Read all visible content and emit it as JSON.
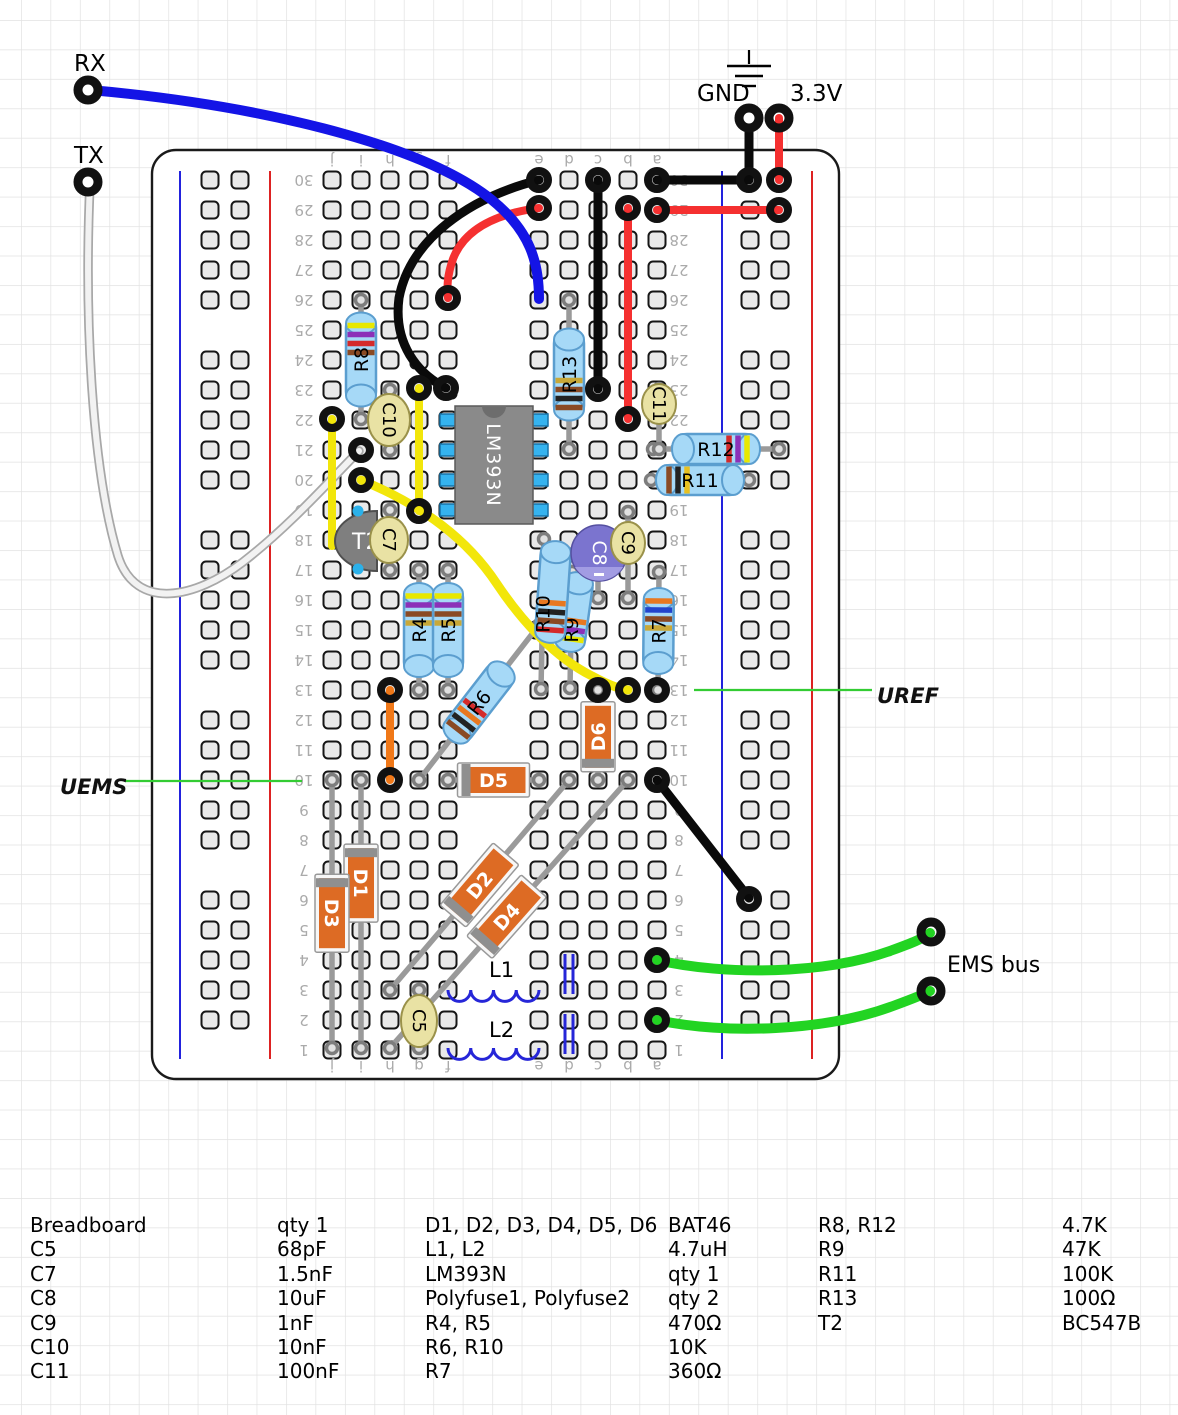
{
  "labels": {
    "rx": "RX",
    "tx": "TX",
    "gnd": "GND",
    "v33": "3.3V",
    "uref": "UREF",
    "uems": "UEMS",
    "ems_bus": "EMS bus"
  },
  "palette": {
    "grid": "#e2e2e2",
    "hole_fill": "#e9e9e9",
    "hole_stroke": "#161616",
    "rail_blue": "#2222dd",
    "rail_red": "#dd2222",
    "resistor_fill": "#a6d9f7",
    "resistor_stroke": "#5b9ecf",
    "diode_fill": "#dd6b24",
    "diode_band": "#8f8f8f",
    "cap_fill": "#e9e2a4",
    "cap_stroke": "#9a914a",
    "elco_fill": "#7b74cf",
    "elco_light": "#a29ce3",
    "ic_fill": "#8a8a8a",
    "ic_pin": "#35b3ef",
    "wire_black": "#0a0a0a",
    "wire_red": "#f53030",
    "wire_blue": "#1414e6",
    "wire_yellow": "#f2e60a",
    "wire_orange": "#f07818",
    "wire_green": "#22d422",
    "wire_white": "#f2f2f2",
    "callout_green": "#33cc33",
    "lead": "#9a9a9a",
    "label_gray": "#aaaaaa"
  },
  "board": {
    "x": 152,
    "y": 150,
    "w": 687,
    "h": 929,
    "rows": 30,
    "row_y30": 180,
    "pitch": 30,
    "cols": {
      "j": 332,
      "i": 361,
      "h": 390,
      "g": 419,
      "f": 448,
      "e": 539,
      "d": 569,
      "c": 598,
      "b": 628,
      "a": 657
    },
    "col_letters": [
      "j",
      "i",
      "h",
      "g",
      "f",
      "e",
      "d",
      "c",
      "b",
      "a"
    ],
    "letters_y": [
      160,
      1066
    ],
    "numbers_x": [
      304,
      679
    ],
    "left_rail": {
      "blue": 180,
      "red": 270,
      "cols": [
        210,
        240
      ]
    },
    "right_rail": {
      "blue": 722,
      "red": 812,
      "cols": [
        750,
        780
      ]
    },
    "rail_y": [
      171,
      1059
    ]
  },
  "pins": [
    {
      "name": "rx-pin",
      "x": 88,
      "y": 90
    },
    {
      "name": "tx-pin",
      "x": 88,
      "y": 182
    },
    {
      "name": "gnd-pin",
      "x": 749,
      "y": 118
    },
    {
      "name": "3v3-pin",
      "x": 779,
      "y": 118
    },
    {
      "name": "ems-pin-1",
      "x": 931,
      "y": 932
    },
    {
      "name": "ems-pin-2",
      "x": 931,
      "y": 991
    }
  ],
  "wires": [
    {
      "id": "tx-wire",
      "color": "#f2f2f2",
      "w": 6,
      "under": "#a8a8a8",
      "uw": 9.5,
      "d": "M90,183 C84,320 92,470 118,556 C136,612 196,598 243,562 C291,525 332,478 359,451"
    },
    {
      "id": "red-arc-wire",
      "color": "#f53030",
      "w": 8,
      "d": "M539,208 C494,214 464,230 453,259 C447,276 447,287 448,298"
    },
    {
      "id": "black-arc-wire",
      "color": "#0a0a0a",
      "w": 9,
      "d": "M539,180 C468,198 410,240 399,298 C393,344 418,374 446,388"
    },
    {
      "id": "black-vert-wire",
      "color": "#0a0a0a",
      "w": 9,
      "d": "M598,180 L598,389"
    },
    {
      "id": "red-vert-wire",
      "color": "#f53030",
      "w": 8,
      "d": "M628,208 L628,419"
    },
    {
      "id": "black-row30-wire",
      "color": "#0a0a0a",
      "w": 9,
      "d": "M657,180 L749,180"
    },
    {
      "id": "red-row29-wire",
      "color": "#f53030",
      "w": 8,
      "d": "M657,210 L779,210"
    },
    {
      "id": "gnd-drop-wire",
      "color": "#0a0a0a",
      "w": 9,
      "d": "M749,118 L749,180"
    },
    {
      "id": "3v3-drop-wire",
      "color": "#f53030",
      "w": 8,
      "d": "M779,118 L779,180"
    },
    {
      "id": "yellow-j-wire",
      "color": "#f2e60a",
      "w": 8,
      "d": "M332,419 L332,546"
    },
    {
      "id": "yellow-g-wire",
      "color": "#f2e60a",
      "w": 8,
      "d": "M419,388 L419,511"
    },
    {
      "id": "yellow-curve-wire",
      "color": "#f2e60a",
      "w": 9,
      "d": "M361,480 C424,506 468,540 497,584 C523,623 556,658 592,676 C605,683 618,689 628,690"
    },
    {
      "id": "orange-wire",
      "color": "#f07818",
      "w": 8,
      "d": "M390,690 L390,780"
    },
    {
      "id": "black-diag-wire",
      "color": "#0a0a0a",
      "w": 9,
      "d": "M657,780 L749,898"
    },
    {
      "id": "green-ems-wire-1",
      "color": "#22d422",
      "w": 10,
      "d": "M657,960 C726,976 826,974 890,951 C909,944 923,939 930,933"
    },
    {
      "id": "green-ems-wire-2",
      "color": "#22d422",
      "w": 10,
      "d": "M657,1020 C726,1035 826,1031 893,1006 C912,999 925,994 930,991"
    },
    {
      "id": "rx-wire",
      "color": "#1414e6",
      "w": 10,
      "d": "M90,90 C250,104 420,142 492,200 C530,231 539,262 539,299"
    }
  ],
  "rings": [
    [
      539,
      180
    ],
    [
      446,
      388
    ],
    [
      539,
      208
    ],
    [
      448,
      298
    ],
    [
      598,
      180
    ],
    [
      598,
      389
    ],
    [
      628,
      208
    ],
    [
      628,
      419
    ],
    [
      657,
      180
    ],
    [
      749,
      180
    ],
    [
      657,
      210
    ],
    [
      779,
      210
    ],
    [
      779,
      180
    ],
    [
      361,
      450
    ],
    [
      332,
      419
    ],
    [
      419,
      388
    ],
    [
      419,
      511
    ],
    [
      361,
      480
    ],
    [
      628,
      690
    ],
    [
      390,
      690
    ],
    [
      390,
      780
    ],
    [
      657,
      780
    ],
    [
      749,
      899
    ],
    [
      657,
      960
    ],
    [
      657,
      1020
    ],
    [
      657,
      690
    ],
    [
      598,
      690
    ]
  ],
  "resistors": [
    {
      "id": "R8",
      "label": "R8",
      "x1": 361,
      "y1": 300,
      "x2": 361,
      "y2": 419,
      "body": 92,
      "bands": [
        "#e8e800",
        "#8c30b8",
        "#d42a2a",
        "#8a4a24"
      ],
      "bands_end": 0,
      "label_rot": -90
    },
    {
      "id": "R13",
      "label": "R13",
      "x1": 569,
      "y1": 300,
      "x2": 569,
      "y2": 449,
      "body": 90,
      "bands": [
        "#8a4a24",
        "#222222",
        "#8a4a24",
        "#c8a838"
      ],
      "bands_end": 1,
      "label_rot": -90
    },
    {
      "id": "R4",
      "label": "R4",
      "x1": 419,
      "y1": 570,
      "x2": 419,
      "y2": 690,
      "body": 92,
      "bands": [
        "#e8e800",
        "#8c30b8",
        "#8a4a24",
        "#c8a838"
      ],
      "bands_end": 0,
      "label_rot": -90
    },
    {
      "id": "R5",
      "label": "R5",
      "x1": 448,
      "y1": 570,
      "x2": 448,
      "y2": 690,
      "body": 92,
      "bands": [
        "#e8e800",
        "#8c30b8",
        "#8a4a24",
        "#c8a838"
      ],
      "bands_end": 0,
      "label_rot": -90
    },
    {
      "id": "R7",
      "label": "R7",
      "x1": 659,
      "y1": 572,
      "x2": 658,
      "y2": 690,
      "body": 84,
      "bands": [
        "#e87820",
        "#2244cc",
        "#8a4a24",
        "#c8a838"
      ],
      "bands_end": 0,
      "label_rot": -90
    },
    {
      "id": "R6",
      "label": "R6",
      "x1": 419,
      "y1": 780,
      "x2": 539,
      "y2": 625,
      "body": 92,
      "bands": [
        "#8a4a24",
        "#222222",
        "#e87820",
        "#d42a2a"
      ],
      "bands_end": 0,
      "label_rot": -52
    },
    {
      "id": "R9",
      "label": "R9",
      "x1": 572,
      "y1": 572,
      "x2": 570,
      "y2": 688,
      "body": 78,
      "bands": [
        "#e8e800",
        "#8c30b8",
        "#e87820"
      ],
      "bands_end": 0,
      "label_rot": -90,
      "bx": 574,
      "by": 612,
      "brot": -82
    },
    {
      "id": "R10",
      "label": "R10",
      "x1": 544,
      "y1": 539,
      "x2": 541,
      "y2": 689,
      "body": 100,
      "bands": [
        "#d42a2a",
        "#8a4a24",
        "#222222",
        "#e87820"
      ],
      "bands_end": 0,
      "label_rot": -90,
      "bx": 553,
      "by": 592,
      "brot": -86
    },
    {
      "id": "R12",
      "label": "R12",
      "x1": 653,
      "y1": 449,
      "x2": 779,
      "y2": 449,
      "body": 86,
      "bands": [
        "#e8e800",
        "#8c30b8",
        "#d42a2a"
      ],
      "bands_end": 1,
      "label_rot": 0
    },
    {
      "id": "R11",
      "label": "R11",
      "x1": 651,
      "y1": 480,
      "x2": 749,
      "y2": 480,
      "body": 86,
      "bands": [
        "#8a4a24",
        "#222222",
        "#e8c020"
      ],
      "bands_end": 0,
      "label_rot": 0
    }
  ],
  "diodes": [
    {
      "id": "D1",
      "label": "D1",
      "x1": 361,
      "y1": 780,
      "x2": 361,
      "y2": 1048,
      "body": 70,
      "band_end": 0,
      "body_t": 0.385,
      "label_rot": 90
    },
    {
      "id": "D3",
      "label": "D3",
      "x1": 332,
      "y1": 780,
      "x2": 332,
      "y2": 1048,
      "body": 70,
      "band_end": 0,
      "body_t": 0.497,
      "label_rot": 90
    },
    {
      "id": "D2",
      "label": "D2",
      "x1": 390,
      "y1": 990,
      "x2": 569,
      "y2": 780,
      "body": 74,
      "band_end": 0,
      "body_t": 0.5,
      "label_rot": -50
    },
    {
      "id": "D4",
      "label": "D4",
      "x1": 390,
      "y1": 1048,
      "x2": 628,
      "y2": 780,
      "body": 74,
      "band_end": 0,
      "body_t": 0.49,
      "label_rot": -48
    },
    {
      "id": "D5",
      "label": "D5",
      "x1": 448,
      "y1": 780,
      "x2": 539,
      "y2": 780,
      "body": 64,
      "band_end": 0,
      "body_t": 0.5,
      "label_rot": 0
    },
    {
      "id": "D6",
      "label": "D6",
      "x1": 598,
      "y1": 690,
      "x2": 598,
      "y2": 780,
      "body": 62,
      "band_end": 1,
      "body_t": 0.52,
      "label_rot": -90
    }
  ],
  "capacitors": [
    {
      "id": "C10",
      "label": "C10",
      "cx": 389,
      "cy": 420,
      "rx": 21,
      "ry": 26,
      "lead": [
        390,
        390,
        390,
        450
      ]
    },
    {
      "id": "C7",
      "label": "C7",
      "cx": 389,
      "cy": 540,
      "rx": 19,
      "ry": 23,
      "lead": [
        390,
        510,
        390,
        570
      ]
    },
    {
      "id": "C9",
      "label": "C9",
      "cx": 628,
      "cy": 543,
      "rx": 17,
      "ry": 21,
      "lead": [
        628,
        512,
        628,
        598
      ]
    },
    {
      "id": "C11",
      "label": "C11",
      "cx": 659,
      "cy": 404,
      "rx": 17,
      "ry": 20,
      "lead": [
        659,
        389,
        659,
        449
      ]
    },
    {
      "id": "C5",
      "label": "C5",
      "cx": 419,
      "cy": 1021,
      "rx": 18,
      "ry": 26,
      "lead": [
        419,
        990,
        419,
        1048
      ]
    }
  ],
  "electrolytic": {
    "id": "C8",
    "label": "C8",
    "cx": 599,
    "cy": 553,
    "r": 28,
    "lead": [
      598,
      540,
      598,
      598
    ]
  },
  "ic": {
    "label": "LM393N",
    "x": 455,
    "y": 406,
    "w": 78,
    "h": 118,
    "pins_y": [
      420,
      450,
      480,
      510
    ]
  },
  "transistor": {
    "label": "T2",
    "cx": 377,
    "cy": 541,
    "rx": 42,
    "ry": 30,
    "pins": [
      [
        358,
        511
      ],
      [
        358,
        569
      ]
    ]
  },
  "inductors": [
    {
      "id": "L1",
      "label": "L1",
      "x": 448,
      "y": 990,
      "len": 91,
      "bumps": 4,
      "lx": 489,
      "ly": 977
    },
    {
      "id": "L2",
      "label": "L2",
      "x": 448,
      "y": 1048,
      "len": 91,
      "bumps": 4,
      "lx": 489,
      "ly": 1037
    }
  ],
  "polyfuses": [
    {
      "id": "Polyfuse1",
      "xa": 565,
      "xb": 573,
      "y1": 954,
      "y2": 994
    },
    {
      "id": "Polyfuse2",
      "xa": 565,
      "xb": 573,
      "y1": 1014,
      "y2": 1054
    }
  ],
  "callouts": [
    {
      "id": "uref",
      "x1": 694,
      "y1": 690,
      "x2": 872,
      "y2": 690,
      "label_key": "uref",
      "tx": 877,
      "ty": 703
    },
    {
      "id": "uems",
      "x1": 125,
      "y1": 781,
      "x2": 302,
      "y2": 781,
      "label_key": "uems",
      "tx": 60,
      "ty": 794
    }
  ],
  "texts": [
    {
      "key": "rx",
      "x": 74,
      "y": 71,
      "size": 23
    },
    {
      "key": "tx",
      "x": 74,
      "y": 163,
      "size": 23
    },
    {
      "key": "gnd",
      "x": 697,
      "y": 101,
      "size": 23
    },
    {
      "key": "v33",
      "x": 790,
      "y": 101,
      "size": 23
    },
    {
      "key": "ems_bus",
      "x": 947,
      "y": 972,
      "size": 22
    }
  ],
  "ground_symbol": {
    "stem": [
      749,
      50,
      749,
      64
    ],
    "lines": [
      [
        727,
        66,
        771,
        66
      ],
      [
        735,
        76,
        763,
        76
      ],
      [
        742,
        86,
        756,
        86
      ]
    ]
  },
  "parts_list": {
    "row_h": 24.4,
    "groups": [
      {
        "x_name": 30,
        "x_value": 277,
        "rows": [
          [
            "Breadboard",
            "qty 1"
          ],
          [
            "C5",
            "68pF"
          ],
          [
            "C7",
            "1.5nF"
          ],
          [
            "C8",
            "10uF"
          ],
          [
            "C9",
            "1nF"
          ],
          [
            "C10",
            "10nF"
          ],
          [
            "C11",
            "100nF"
          ]
        ]
      },
      {
        "x_name": 425,
        "x_value": 668,
        "rows": [
          [
            "D1, D2, D3, D4, D5, D6",
            "BAT46"
          ],
          [
            "L1, L2",
            "4.7uH"
          ],
          [
            "LM393N",
            "qty 1"
          ],
          [
            "Polyfuse1, Polyfuse2",
            "qty 2"
          ],
          [
            "R4, R5",
            "470Ω"
          ],
          [
            "R6, R10",
            "10K"
          ],
          [
            "R7",
            "360Ω"
          ]
        ]
      },
      {
        "x_name": 818,
        "x_value": 1062,
        "rows": [
          [
            "R8, R12",
            "4.7K"
          ],
          [
            "R9",
            "47K"
          ],
          [
            "R11",
            "100K"
          ],
          [
            "R13",
            "100Ω"
          ],
          [
            "T2",
            "BC547B"
          ]
        ]
      }
    ]
  }
}
